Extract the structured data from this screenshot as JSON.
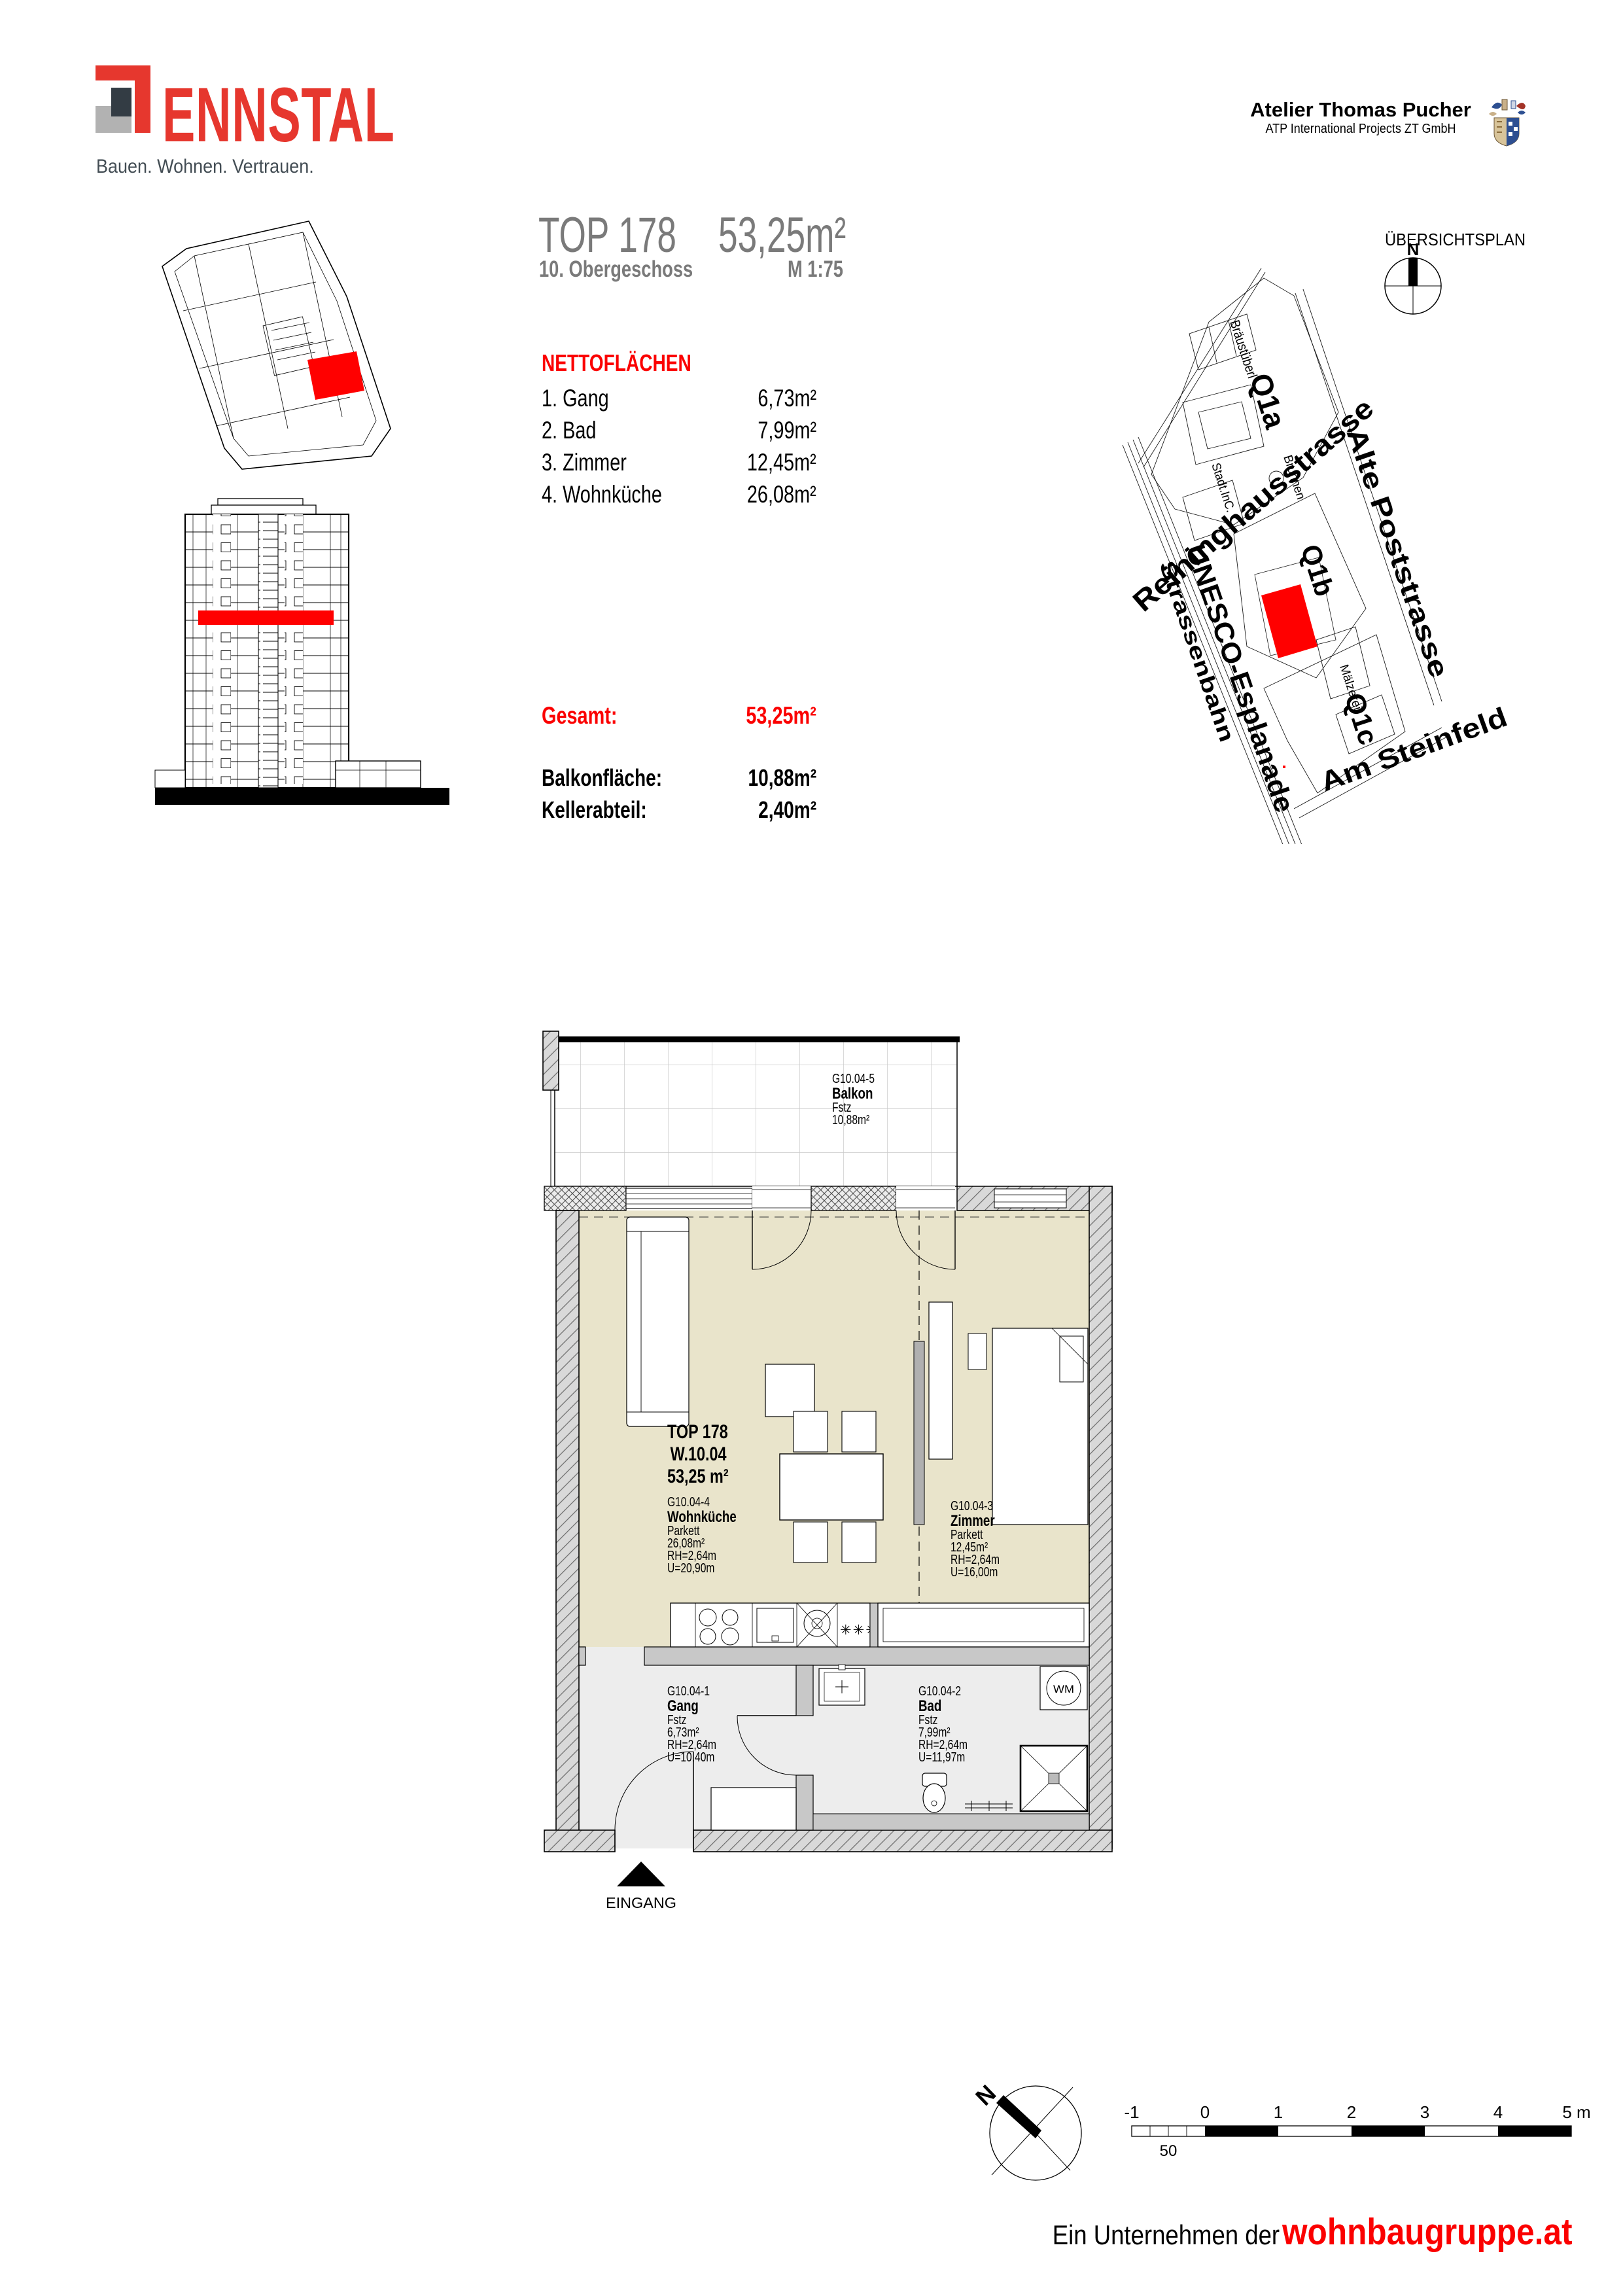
{
  "brand": {
    "name": "ENNSTAL",
    "tagline": "Bauen. Wohnen. Vertrauen."
  },
  "architect": {
    "name": "Atelier Thomas Pucher",
    "firm": "ATP International Projects ZT GmbH"
  },
  "title_block": {
    "unit": "TOP 178",
    "floor": "10. Obergeschoss",
    "area": "53,25m²",
    "scale": "M 1:75"
  },
  "netto": {
    "heading": "NETTOFLÄCHEN",
    "rows": [
      {
        "label": "1. Gang",
        "value": "6,73m²"
      },
      {
        "label": "2. Bad",
        "value": "7,99m²"
      },
      {
        "label": "3. Zimmer",
        "value": "12,45m²"
      },
      {
        "label": "4. Wohnküche",
        "value": "26,08m²"
      }
    ]
  },
  "summary": {
    "gesamt_label": "Gesamt:",
    "gesamt_value": "53,25m²",
    "rows": [
      {
        "label": "Balkonfläche:",
        "value": "10,88m²"
      },
      {
        "label": "Kellerabteil:",
        "value": "2,40m²"
      }
    ]
  },
  "site_plan": {
    "heading": "ÜBERSICHTSPLAN",
    "north": "N",
    "streets": {
      "reininghaus": "Reininghausstrasse",
      "tram": "Strassenbahn",
      "unesco": "UNESCO-Esplanade",
      "poststrasse": "Alte Poststrasse",
      "steinfeld": "Am Steinfeld"
    },
    "blocks": {
      "q1a": "Q1a",
      "q1b": "Q1b",
      "q1c": "Q1c"
    },
    "places": {
      "braeustueberl": "Bräustüberl",
      "brunnen": "Brunnen",
      "stadt": "Stadt.InC.",
      "maelzerei": "Mälzerei"
    }
  },
  "floor_plan": {
    "unit_label": {
      "line1": "TOP 178",
      "line2": "W.10.04",
      "line3": "53,25 m²"
    },
    "balkon": {
      "code": "G10.04-5",
      "name": "Balkon",
      "floor": "Fstz",
      "area": "10,88m²"
    },
    "wohnkueche": {
      "code": "G10.04-4",
      "name": "Wohnküche",
      "floor": "Parkett",
      "area": "26,08m²",
      "rh": "RH=2,64m",
      "u": "U=20,90m"
    },
    "zimmer": {
      "code": "G10.04-3",
      "name": "Zimmer",
      "floor": "Parkett",
      "area": "12,45m²",
      "rh": "RH=2,64m",
      "u": "U=16,00m"
    },
    "gang": {
      "code": "G10.04-1",
      "name": "Gang",
      "floor": "Fstz",
      "area": "6,73m²",
      "rh": "RH=2,64m",
      "u": "U=10,40m"
    },
    "bad": {
      "code": "G10.04-2",
      "name": "Bad",
      "floor": "Fstz",
      "area": "7,99m²",
      "rh": "RH=2,64m",
      "u": "U=11,97m"
    },
    "entrance": "EINGANG",
    "wm": "WM",
    "freezer_symbol": "✳✳✳"
  },
  "scale_bar": {
    "labels": [
      "-1",
      "0",
      "1",
      "2",
      "3",
      "4",
      "5 m"
    ],
    "sub_label": "50"
  },
  "footer": {
    "prefix": "Ein Unternehmen der",
    "brand": "wohnbaugruppe.at"
  },
  "colors": {
    "brand_red": "#e6372e",
    "accent_red": "#fb0000",
    "plan_red": "#ff0000",
    "title_gray": "#7a7a7a",
    "room_beige": "#e9e4cb",
    "floor_gray": "#ededed",
    "wall_gray": "#c8c8c8"
  }
}
